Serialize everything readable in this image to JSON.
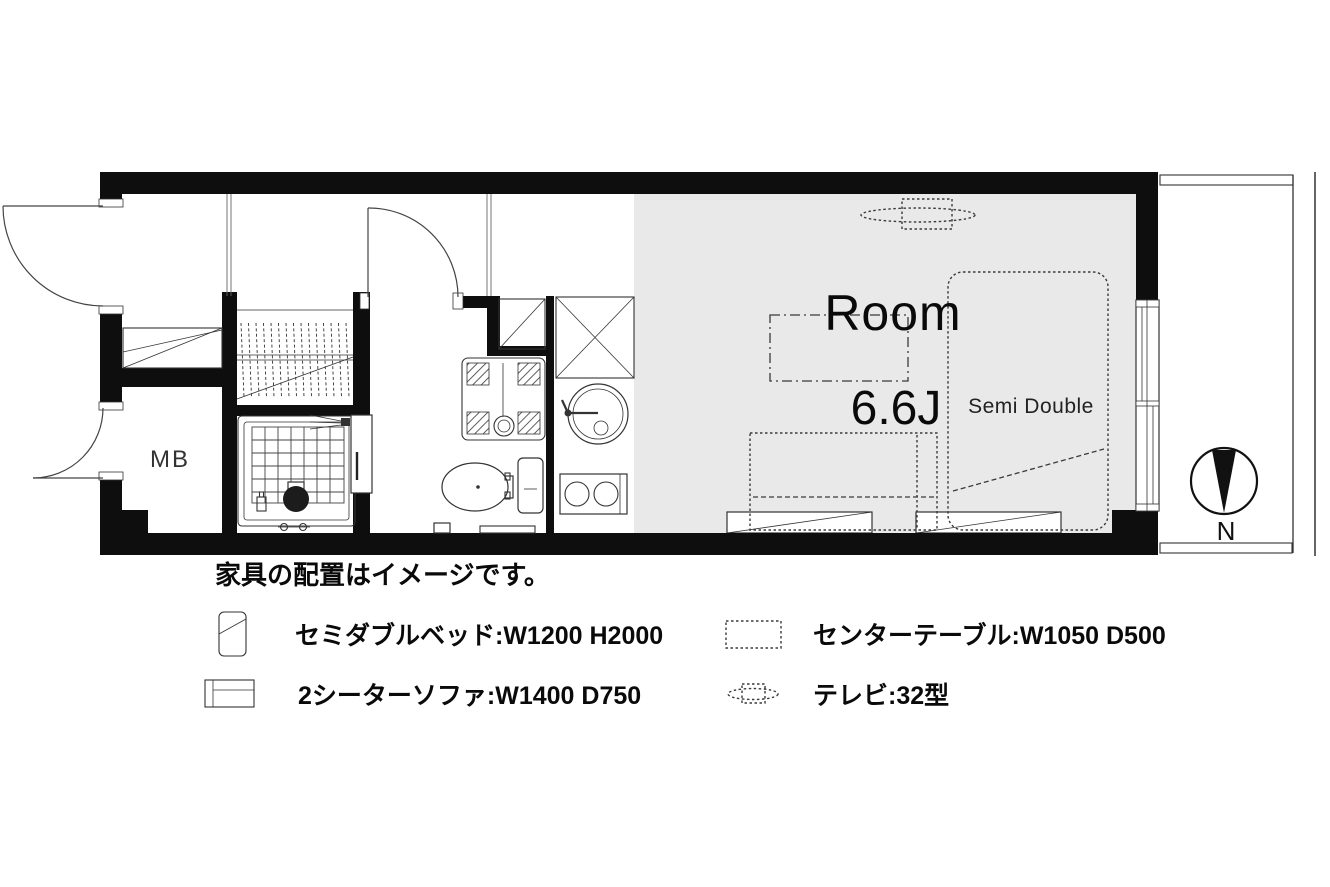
{
  "plan": {
    "room_label": "Room",
    "room_size_label": "6.6J",
    "bed_size_label": "Semi Double",
    "meter_box_label": "MB",
    "compass_north_label": "N"
  },
  "legend": {
    "note": "家具の配置はイメージです。",
    "items": [
      {
        "name": "semi-double-bed",
        "label": "セミダブルベッド:W1200 H2000"
      },
      {
        "name": "two-seater-sofa",
        "label": "2シーターソファ:W1400 D750"
      },
      {
        "name": "center-table",
        "label": "センターテーブル:W1050 D500"
      },
      {
        "name": "tv",
        "label": "テレビ:32型"
      }
    ]
  },
  "colors": {
    "wall": "#0e0e0e",
    "room_fill": "#e9e9e9",
    "line": "#333333",
    "background": "#ffffff"
  }
}
